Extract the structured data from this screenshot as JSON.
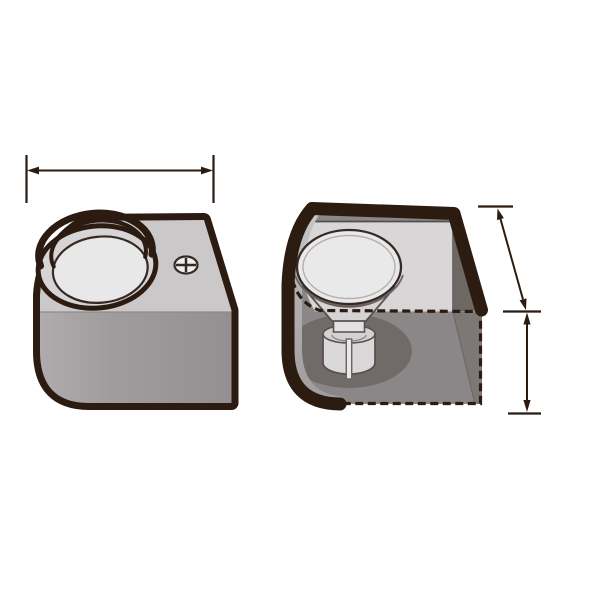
{
  "illustration": {
    "kind": "technical-product-diagram",
    "figures": {
      "left": {
        "label": "Housing exterior view",
        "features": [
          "recessed circular opening",
          "fixing screw"
        ]
      },
      "right": {
        "label": "Housing cutaway view",
        "features": [
          "GU10 spotlight bulb inside",
          "hidden edges shown dashed"
        ]
      }
    },
    "dimension_lines": {
      "width": {
        "label": "Overall width dimension",
        "orientation": "horizontal"
      },
      "depth": {
        "label": "Top depth dimension",
        "orientation": "slanted"
      },
      "height": {
        "label": "Front height dimension",
        "orientation": "vertical"
      }
    }
  },
  "colors": {
    "background": "#ffffff",
    "outline": "#2b1b10",
    "dim_line": "#2b1b10",
    "top_face": "#cbc8c9",
    "front_a": "#b0acad",
    "front_b": "#a19d9e",
    "front_c": "#949091",
    "ring": "#d7d4d5",
    "recess_inner": "#e9e8e8",
    "band_top": "#c9c6c7",
    "band_mid": "#b3afb0",
    "band_bottom": "#a09c9d",
    "back_wall": "#d8d6d7",
    "right_wall_upper": "#6e6865",
    "right_wall_lower": "#7d7876",
    "floor": "#8b8788",
    "floor_shadow": "#706b69",
    "bulb_face": "#eae9e9",
    "bulb_cone": "#d5d3d4",
    "bulb_neck": "#e2e0e1",
    "bulb_base": "#d9d7d8",
    "base_top": "#d3d1d2",
    "slot_fill": "#e9e8e8",
    "edge_soft": "#59514f",
    "edge_mid": "#6b6465",
    "edge_faint": "#8e8a8b",
    "wall_edge": "#564e4b",
    "screw_fill": "#efeeee",
    "screw_stroke": "#352a23"
  }
}
